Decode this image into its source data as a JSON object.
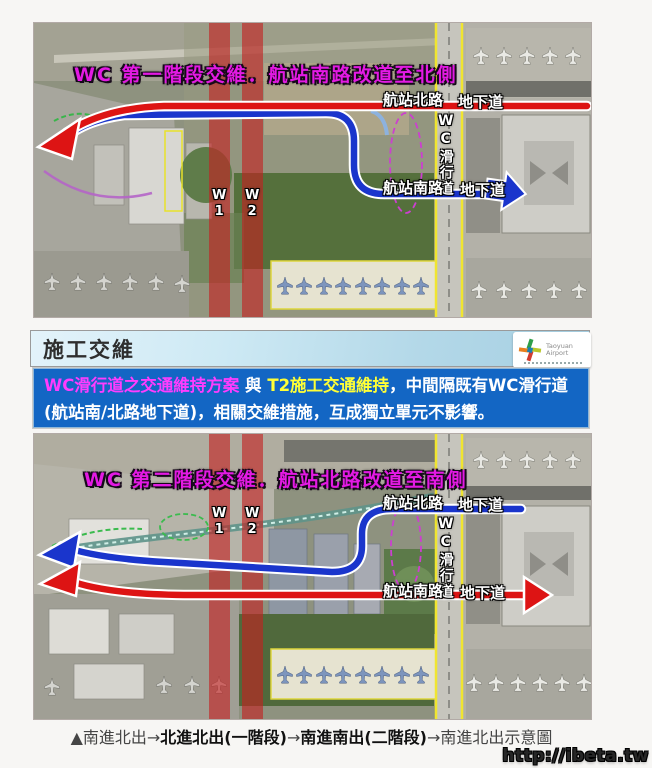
{
  "page": {
    "background": "#f7f6f4",
    "watermark": "http://ibeta.tw"
  },
  "colors": {
    "route_red": "#dd1414",
    "route_blue": "#1a35cc",
    "closure_overlay_red": "#c42020",
    "taxiway_outline_yellow": "#f0e530",
    "title_magenta": "#e31ae3",
    "notice_background_blue": "#1366c4",
    "notice_text_magenta": "#ff3cff",
    "notice_text_yellow": "#ffff36",
    "header_bar_blue": "#c3e2ef"
  },
  "phase1_map": {
    "title": "WC 第一階段交維．航站南路改道至北側",
    "labels": {
      "north_road": "航站北路",
      "north_underpass": "地下道",
      "taxiway": "WC滑行道",
      "south_road": "航站南路",
      "south_underpass": "地下道",
      "w1": "W1",
      "w2": "W2"
    }
  },
  "section": {
    "header_title": "施工交維",
    "logo": {
      "name": "Taoyuan Airport",
      "line1": "Taoyuan",
      "line2": "Airport"
    }
  },
  "notice": {
    "segment_magenta": "WC滑行道之交通維持方案",
    "segment_white_1": " 與 ",
    "segment_yellow": "T2施工交通維持",
    "segment_white_2": "，中間隔既有WC滑行道",
    "line2": "(航站南/北路地下道)，相關交維措施，互成獨立單元不影響。"
  },
  "phase2_map": {
    "title": "WC 第二階段交維．航站北路改道至南側",
    "labels": {
      "north_road": "航站北路",
      "north_underpass": "地下道",
      "taxiway": "WC滑行道",
      "south_road": "航站南路",
      "south_underpass": "地下道",
      "w1": "W1",
      "w2": "W2"
    }
  },
  "caption": {
    "prefix": "▲南進北出→",
    "stage1": "北進北出(一階段)",
    "arrow1": "→",
    "stage2": "南進南出(二階段)",
    "suffix": "→南進北出示意圖"
  }
}
